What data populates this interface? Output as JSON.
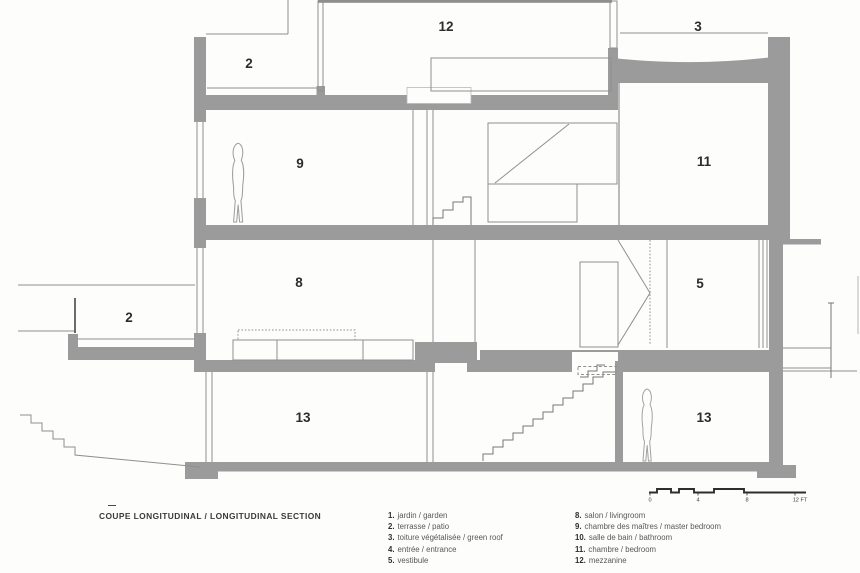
{
  "colors": {
    "wall_gray": "#9b9b9b",
    "thin_line": "#8f8f8f",
    "label_dark": "#2d2d2d",
    "background": "#fdfdfc"
  },
  "caption": {
    "title": "COUPE LONGITUDINAL / LONGITUDINAL SECTION"
  },
  "rooms": [
    {
      "label": "2"
    },
    {
      "label": "12"
    },
    {
      "label": "3"
    },
    {
      "label": "9"
    },
    {
      "label": "11"
    },
    {
      "label": "8"
    },
    {
      "label": "5"
    },
    {
      "label": "2"
    },
    {
      "label": "13"
    },
    {
      "label": "13"
    }
  ],
  "legend": {
    "left": [
      {
        "num": "1.",
        "label": "jardin / garden"
      },
      {
        "num": "2.",
        "label": "terrasse / patio"
      },
      {
        "num": "3.",
        "label": "toiture végétalisée / green roof"
      },
      {
        "num": "4.",
        "label": "entrée / entrance"
      },
      {
        "num": "5.",
        "label": "vestibule"
      }
    ],
    "right": [
      {
        "num": "8.",
        "label": "salon / livingroom"
      },
      {
        "num": "9.",
        "label": "chambre des maîtres / master bedroom"
      },
      {
        "num": "10.",
        "label": "salle de bain / bathroom"
      },
      {
        "num": "11.",
        "label": "chambre / bedroom"
      },
      {
        "num": "12.",
        "label": "mezzanine"
      }
    ]
  },
  "scale": {
    "ticks": [
      "0",
      "4",
      "8",
      "12 FT"
    ]
  }
}
